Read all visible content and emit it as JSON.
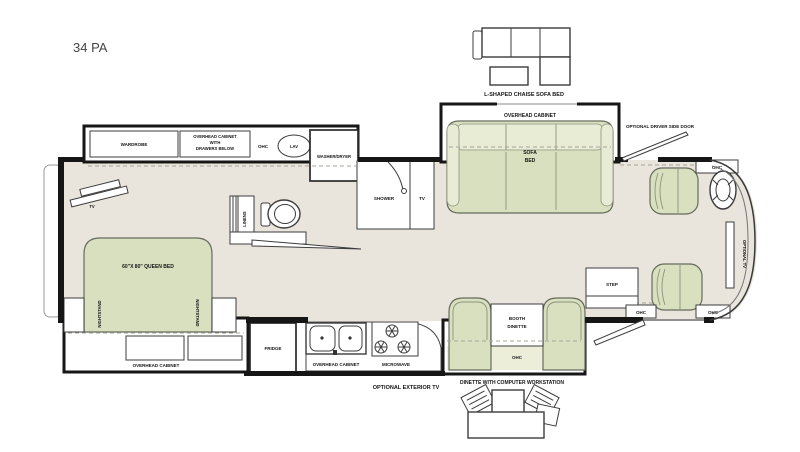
{
  "title": "34 PA",
  "colors": {
    "floor": "#e9e4dc",
    "furniture_green": "#d9e0c0",
    "furniture_green_light": "#e8ecd5",
    "wall": "#161616",
    "background": "#ffffff"
  },
  "options": {
    "chaise_label": "L-SHAPED CHAISE SOFA BED",
    "workstation_label": "DINETTE WITH COMPUTER WORKSTATION",
    "driver_door_label": "OPTIONAL DRIVER SIDE DOOR",
    "exterior_tv_label": "OPTIONAL EXTERIOR TV",
    "optional_tv_label": "OPTIONAL TV"
  },
  "bedroom": {
    "wardrobe": "WARDROBE",
    "overhead_cabinet_drawers": [
      "OVERHEAD CABINET",
      "WITH",
      "DRAWERS BELOW"
    ],
    "queen_bed": "60\"X 80\" QUEEN BED",
    "nightstand": "NIGHTSTAND",
    "overhead_cabinet": "OVERHEAD CABINET",
    "tv": "TV"
  },
  "bath": {
    "ohc": "OHC",
    "lav": "LAV",
    "washer_dryer": "WASHER/DRYER",
    "linens": "LINENS",
    "shower": "SHOWER",
    "tv": "TV"
  },
  "living": {
    "overhead_cabinet": "OVERHEAD CABINET",
    "sofa_bed": [
      "SOFA",
      "BED"
    ]
  },
  "kitchen": {
    "fridge": "FRIDGE",
    "overhead_cabinet": "OVERHEAD CABINET",
    "microwave": "MICROWAVE"
  },
  "dinette": {
    "booth": [
      "BOOTH",
      "DINETTE"
    ],
    "ohc": "OHC"
  },
  "front": {
    "ohc": "OHC",
    "step": "STEP"
  }
}
